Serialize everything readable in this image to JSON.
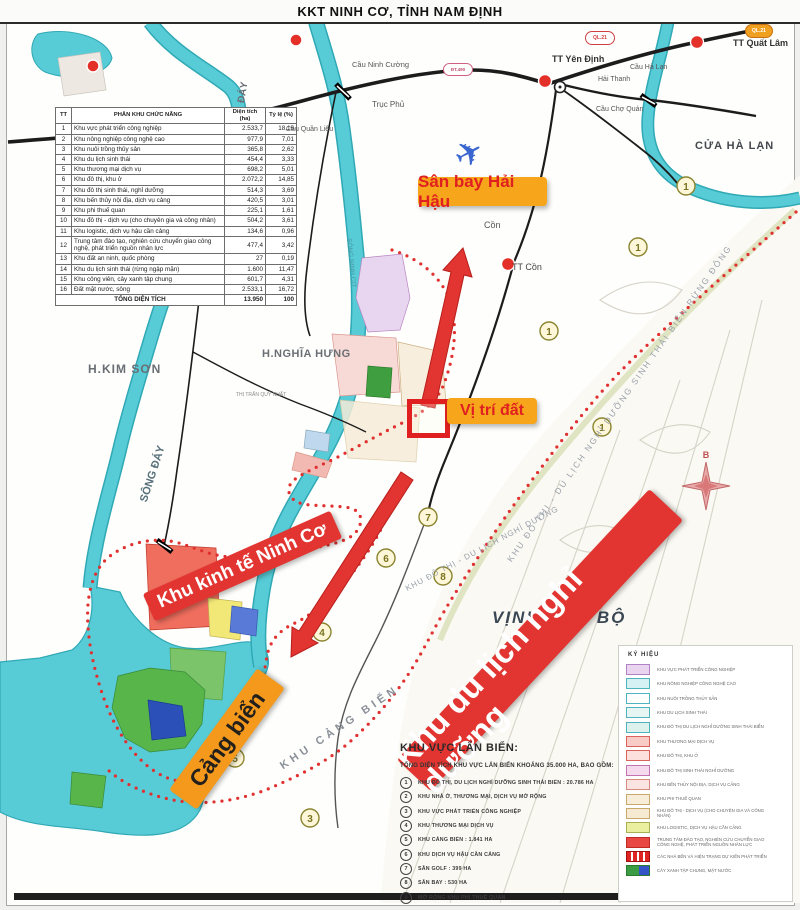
{
  "title": "KKT NINH CƠ, TỈNH NAM ĐỊNH",
  "colors": {
    "accent_orange": "#F7A61B",
    "accent_red": "#E23430",
    "river_cyan": "#57CBD6",
    "boundary_red": "#E03030"
  },
  "callouts": {
    "airport": "Sân bay Hải Hậu",
    "location": "Vị trí đất",
    "seaport": "Cảng biển",
    "economic_zone": "Khu kinh tế Ninh Cơ",
    "resort": "Khu du lịch nghỉ dưỡng"
  },
  "table": {
    "headers": [
      "TT",
      "PHÂN KHU CHỨC NĂNG",
      "Diện tích (ha)",
      "Tỷ lệ (%)"
    ],
    "rows": [
      [
        "1",
        "Khu vực phát triển công nghiệp",
        "2.533,7",
        "18,16"
      ],
      [
        "2",
        "Khu nông nghiệp công nghệ cao",
        "977,9",
        "7,01"
      ],
      [
        "3",
        "Khu nuôi trồng thủy sản",
        "365,8",
        "2,62"
      ],
      [
        "4",
        "Khu du lịch sinh thái",
        "454,4",
        "3,33"
      ],
      [
        "5",
        "Khu thương mại dịch vụ",
        "698,2",
        "5,01"
      ],
      [
        "6",
        "Khu đô thị, khu ở",
        "2.072,2",
        "14,85"
      ],
      [
        "7",
        "Khu đô thị sinh thái, nghỉ dưỡng",
        "514,3",
        "3,69"
      ],
      [
        "8",
        "Khu bến thủy nội địa, dịch vụ cảng",
        "420,5",
        "3,01"
      ],
      [
        "9",
        "Khu phi thuế quan",
        "225,1",
        "1,61"
      ],
      [
        "10",
        "Khu đô thị - dịch vụ (cho chuyên gia và công nhân)",
        "504,2",
        "3,61"
      ],
      [
        "11",
        "Khu logistic, dịch vụ hậu cần cảng",
        "134,6",
        "0,96"
      ],
      [
        "12",
        "Trung tâm đào tạo, nghiên cứu chuyển giao công nghệ, phát triển nguồn nhân lực",
        "477,4",
        "3,42"
      ],
      [
        "13",
        "Khu đất an ninh, quốc phòng",
        "27",
        "0,19"
      ],
      [
        "14",
        "Khu du lịch sinh thái (rừng ngập mặn)",
        "1.600",
        "11,47"
      ],
      [
        "15",
        "Khu công viên, cây xanh tập chung",
        "601,7",
        "4,31"
      ],
      [
        "16",
        "Đất mặt nước, sông",
        "2.533,1",
        "16,72"
      ]
    ],
    "total": {
      "label": "TỔNG DIỆN TÍCH",
      "area": "13.950",
      "pct": "100"
    }
  },
  "legend": {
    "title": "KÝ HIỆU",
    "items": [
      {
        "label": "KHU VỰC PHÁT TRIỂN CÔNG NGHIỆP",
        "fill": "#E9D5EF",
        "stroke": "#B183C6"
      },
      {
        "label": "KHU NÔNG NGHIỆP CÔNG NGHỆ CAO",
        "fill": "#D5F1F3",
        "stroke": "#4FB4BE"
      },
      {
        "label": "KHU NUÔI TRỒNG THỦY SẢN",
        "fill": "#FFFFFF",
        "stroke": "#4FB4BE"
      },
      {
        "label": "KHU DU LỊCH SINH THÁI",
        "fill": "#E8F6F3",
        "stroke": "#4FB4BE"
      },
      {
        "label": "KHU ĐÔ THỊ DU LỊCH NGHỈ DƯỠNG SINH THÁI BIỂN",
        "fill": "#DDF2EC",
        "stroke": "#4FB4BE"
      },
      {
        "label": "KHU THƯƠNG MẠI DỊCH VỤ",
        "fill": "#F8CBC6",
        "stroke": "#D9635A"
      },
      {
        "label": "KHU ĐÔ THỊ, KHU Ở",
        "fill": "#FBE0DE",
        "stroke": "#D9635A"
      },
      {
        "label": "KHU ĐÔ THỊ SINH THÁI NGHỈ DƯỠNG",
        "fill": "#F4DAEC",
        "stroke": "#C273B2"
      },
      {
        "label": "KHU BẾN THỦY NỘI ĐỊA, DỊCH VỤ CẢNG",
        "fill": "#FAE4E1",
        "stroke": "#D98A80"
      },
      {
        "label": "KHU PHI THUẾ QUAN",
        "fill": "#F8EDD9",
        "stroke": "#C9A96B"
      },
      {
        "label": "KHU ĐÔ THỊ - DỊCH VỤ (CHO CHUYÊN GIA VÀ CÔNG NHÂN)",
        "fill": "#F6EBD2",
        "stroke": "#C9A96B"
      },
      {
        "label": "KHU LOGISTIC, DỊCH VỤ HẬU CẦN CẢNG",
        "fill": "#E9EF9F",
        "stroke": "#A9B052"
      },
      {
        "label": "TRUNG TÂM ĐÀO TẠO, NGHIÊN CỨU CHUYỂN GIAO CÔNG NGHỆ, PHÁT TRIỂN NGUỒN NHÂN LỰC",
        "fill": "#E84742",
        "stroke": "#C02A24"
      },
      {
        "label": "CÁC NHÀ BẾN VÀ HIỆN TRẠNG DỰ KIẾN PHÁT TRIỂN",
        "fill": "#E02424",
        "stroke": "#A01010",
        "pattern": "dots"
      },
      {
        "label": "CÂY XANH TẬP CHUNG, MẶT NƯỚC",
        "fill": "#3C9C44",
        "fill2": "#3353C6",
        "stroke": "#2A7A30"
      }
    ]
  },
  "sea_reclaim": {
    "heading": "KHU VỰC LẤN BIỂN:",
    "subheading": "TỔNG DIỆN TÍCH KHU VỰC LẤN BIỂN KHOẢNG 35.000 HA, BAO GỒM:",
    "items": [
      {
        "n": "1",
        "label": "KHU ĐÔ THỊ, DU LỊCH NGHỈ DƯỠNG SINH THÁI BIỂN : 20.786 HA"
      },
      {
        "n": "2",
        "label": "KHU NHÀ Ở, THƯƠNG MẠI, DỊCH VỤ MỞ RỘNG"
      },
      {
        "n": "3",
        "label": "KHU VỰC PHÁT TRIỂN CÔNG NGHIỆP"
      },
      {
        "n": "4",
        "label": "KHU THƯƠNG MẠI DỊCH VỤ"
      },
      {
        "n": "5",
        "label": "KHU CẢNG BIỂN : 1.841 HA"
      },
      {
        "n": "6",
        "label": "KHU DỊCH VỤ HẬU CẦN CẢNG"
      },
      {
        "n": "7",
        "label": "SÂN GOLF : 399 HA"
      },
      {
        "n": "8",
        "label": "SÂN BAY : 530 HA"
      },
      {
        "n": "9",
        "label": "MỞ RỘNG KHU PHI THUẾ QUAN"
      }
    ]
  },
  "map": {
    "labels": {
      "h_kim_son": "H.KIM SƠN",
      "h_nghia_hung": "H.NGHĨA HƯNG",
      "quy_nhat": "THỊ TRẤN QUỸ NHẤT",
      "song_day": "SÔNG ĐÁY",
      "day": "ĐÁY",
      "song_ninh_co": "SÔNG NINH CƠ",
      "cua_ha_lan": "CỬA HÀ LẠN",
      "tt_yen_dinh": "TT Yên Định",
      "hai_thanh": "Hải Thanh",
      "cau_ha_lan": "Cầu Hà Lạn",
      "cau_cho_quan": "Cầu Chợ Quán",
      "tt_quat_lam": "TT Quất Lâm",
      "cau_ninh_cuong": "Cầu Ninh Cường",
      "truc_phu": "Trục Phủ",
      "cau_quan_lieu": "Cầu Quần Liêu",
      "con": "Cồn",
      "tt_con": "TT Cồn",
      "vinh_bac_bo": "VỊNH BẮC BỘ",
      "khu_cang_bien": "KHU CẢNG BIỂN",
      "coastal_strip": "KHU ĐÔ THỊ - DU LỊCH NGHỈ DƯỠNG SINH THÁI BIỂN RỪNG ĐÔNG",
      "coastal_strip2": "KHU ĐÔ THỊ - DU LỊCH NGHỈ DƯỠNG"
    },
    "shields": {
      "ql21": "QL.21",
      "dt490": "ĐT.490"
    },
    "markers": [
      {
        "n": "1"
      },
      {
        "n": "1"
      },
      {
        "n": "1"
      },
      {
        "n": "1"
      },
      {
        "n": "7"
      },
      {
        "n": "8"
      },
      {
        "n": "6"
      },
      {
        "n": "4"
      },
      {
        "n": "5"
      },
      {
        "n": "3"
      }
    ],
    "compass": "B",
    "icons": {
      "plane": "✈"
    }
  }
}
